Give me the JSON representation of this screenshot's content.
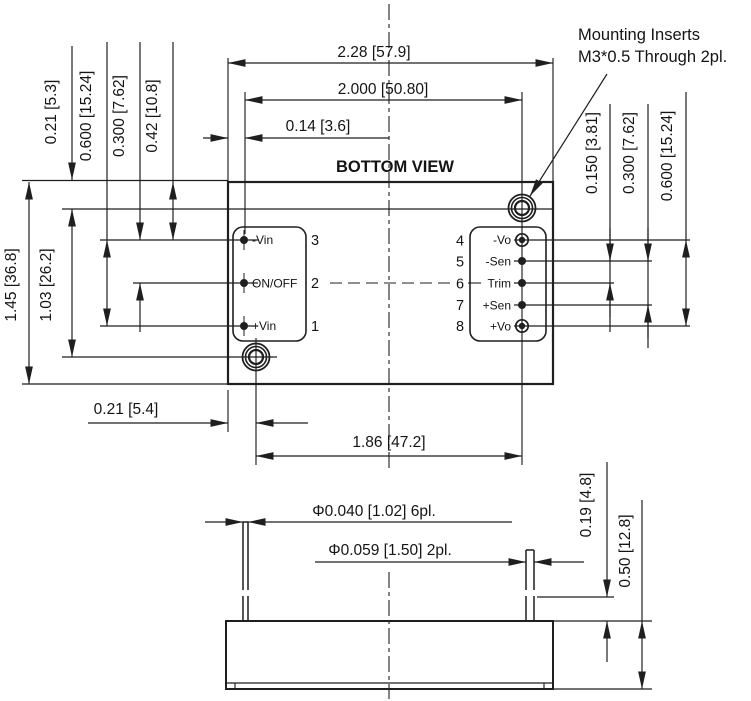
{
  "view_title": "BOTTOM VIEW",
  "note": {
    "line1": "Mounting Inserts",
    "line2": "M3*0.5 Through 2pl."
  },
  "dimensions": {
    "overall_width": "2.28 [57.9]",
    "pin_column_span": "2.000 [50.80]",
    "edge_to_pin_column": "0.14 [3.6]",
    "top_edge_to_insert": "0.21 [5.3]",
    "input_pin_span": "0.600 [15.24]",
    "input_pin_pitch": "0.300 [7.62]",
    "top_edge_to_pin3": "0.42 [10.8]",
    "overall_height": "1.45 [36.8]",
    "insert_vertical_span": "1.03 [26.2]",
    "output_pin_pitch": "0.150 [3.81]",
    "output_sen_span": "0.300 [7.62]",
    "output_pin_span": "0.600 [15.24]",
    "edge_to_insert": "0.21 [5.4]",
    "insert_horizontal_span": "1.86 [47.2]",
    "signal_pin_diameter": "Φ0.040 [1.02] 6pl.",
    "power_pin_diameter": "Φ0.059 [1.50] 2pl.",
    "pin_protrusion": "0.19 [4.8]",
    "case_height": "0.50 [12.8]"
  },
  "pins_left": [
    {
      "num": "3",
      "label": "-Vin"
    },
    {
      "num": "2",
      "label": "ON/OFF"
    },
    {
      "num": "1",
      "label": "+Vin"
    }
  ],
  "pins_right": [
    {
      "num": "4",
      "label": "-Vo"
    },
    {
      "num": "5",
      "label": "-Sen"
    },
    {
      "num": "6",
      "label": "Trim"
    },
    {
      "num": "7",
      "label": "+Sen"
    },
    {
      "num": "8",
      "label": "+Vo"
    }
  ],
  "colors": {
    "line": "#1f1f1f",
    "text": "#141414",
    "background": "#ffffff"
  }
}
